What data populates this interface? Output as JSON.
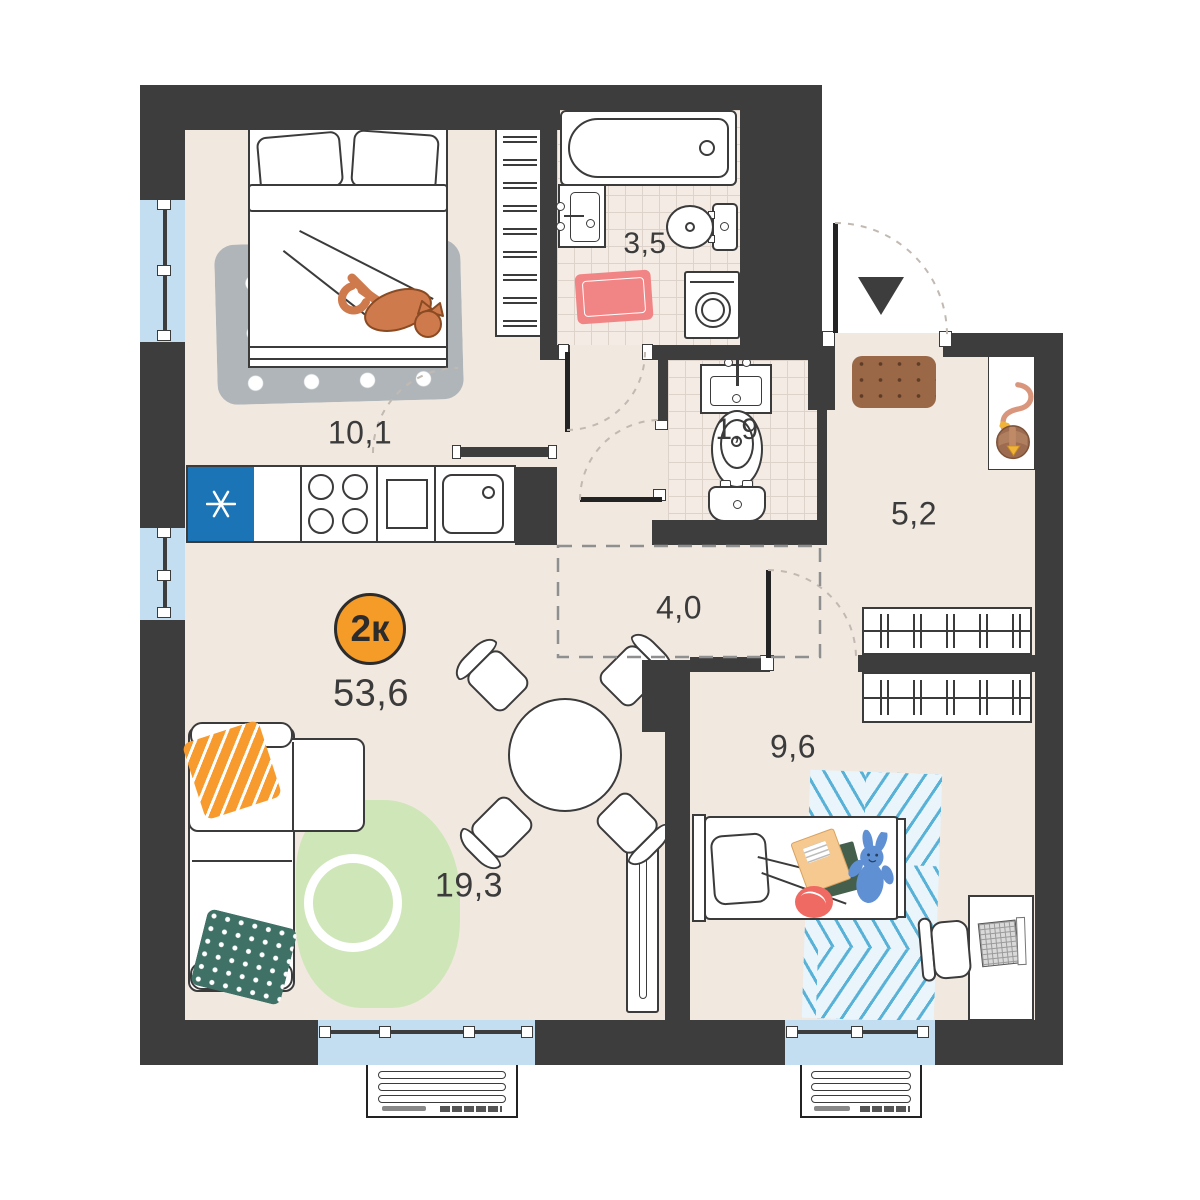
{
  "plan": {
    "title": "apartment floor plan",
    "type_badge": {
      "label": "2к",
      "circle_color": "#f49b28"
    },
    "total_area": "53,6",
    "rooms": [
      {
        "name": "bedroom",
        "area": "10,1"
      },
      {
        "name": "bathroom",
        "area": "3,5"
      },
      {
        "name": "toilet",
        "area": "1,9"
      },
      {
        "name": "hallway",
        "area": "5,2"
      },
      {
        "name": "corridor",
        "area": "4,0"
      },
      {
        "name": "kids-room",
        "area": "9,6"
      },
      {
        "name": "living-kitchen",
        "area": "19,3"
      }
    ],
    "icons": {
      "entrance_arrow": "triangle-down",
      "kitchen_unit_asterisk": "six-spoke-asterisk",
      "cat": "cat-lying-on-bed",
      "bag": "shoulder-bag-on-shelf",
      "toy": "bunny-toy"
    },
    "colors": {
      "wall": "#3d3d3d",
      "floor": "#f1e8e0",
      "tile": "#f4ece4",
      "window_glass": "#c3ddf1",
      "accent_orange": "#f49b28",
      "kitchen_blue": "#1b74b6",
      "rug_pink": "#f18585",
      "rug_green": "#cfe6b9",
      "rug_gray": "#afb5b9",
      "rug_kids_stripe": "#58b1d6",
      "pillow_green": "#3f7166",
      "doormat_brown": "#9a6747",
      "cat_orange": "#cf7a4d",
      "toy_blue": "#5f90d3"
    }
  }
}
